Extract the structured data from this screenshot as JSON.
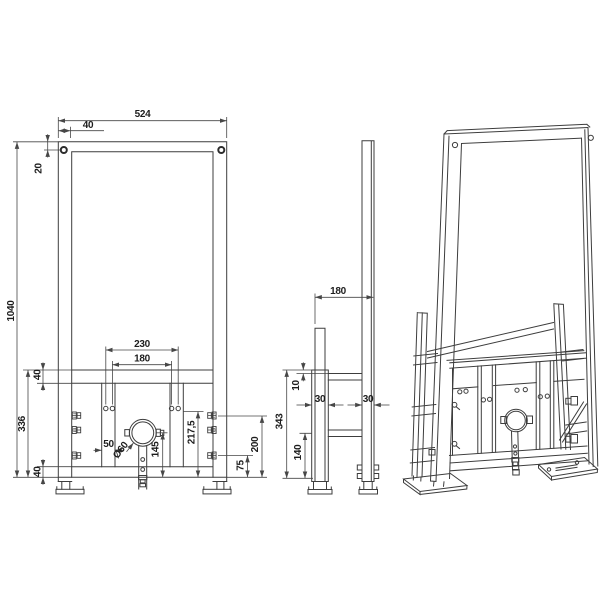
{
  "drawing": {
    "colors": {
      "line": "#3d3d3d",
      "dimension_line": "#474747",
      "text": "#1d1d1d",
      "background": "#ffffff"
    },
    "front_view": {
      "dimensions": {
        "overall_width": "524",
        "profile_width": "40",
        "hole_offset": "20",
        "overall_height": "1040",
        "anchor_spacing_outer": "230",
        "anchor_spacing_inner": "180",
        "top_rail_height": "40",
        "lower_frame_height": "336",
        "strip_width": "50",
        "pipe_diameter": "Ø60",
        "pipe_center_height": "145",
        "upper_bolt_height": "217,5",
        "bottom_rail_height": "40",
        "lower_bolt_height": "75",
        "mid_bolt_height": "200"
      }
    },
    "side_view": {
      "dimensions": {
        "depth": "180",
        "top_offset": "10",
        "bracket_width": "30",
        "post_width": "30",
        "bracket_height": "343",
        "lower_bar_height": "140"
      }
    }
  }
}
